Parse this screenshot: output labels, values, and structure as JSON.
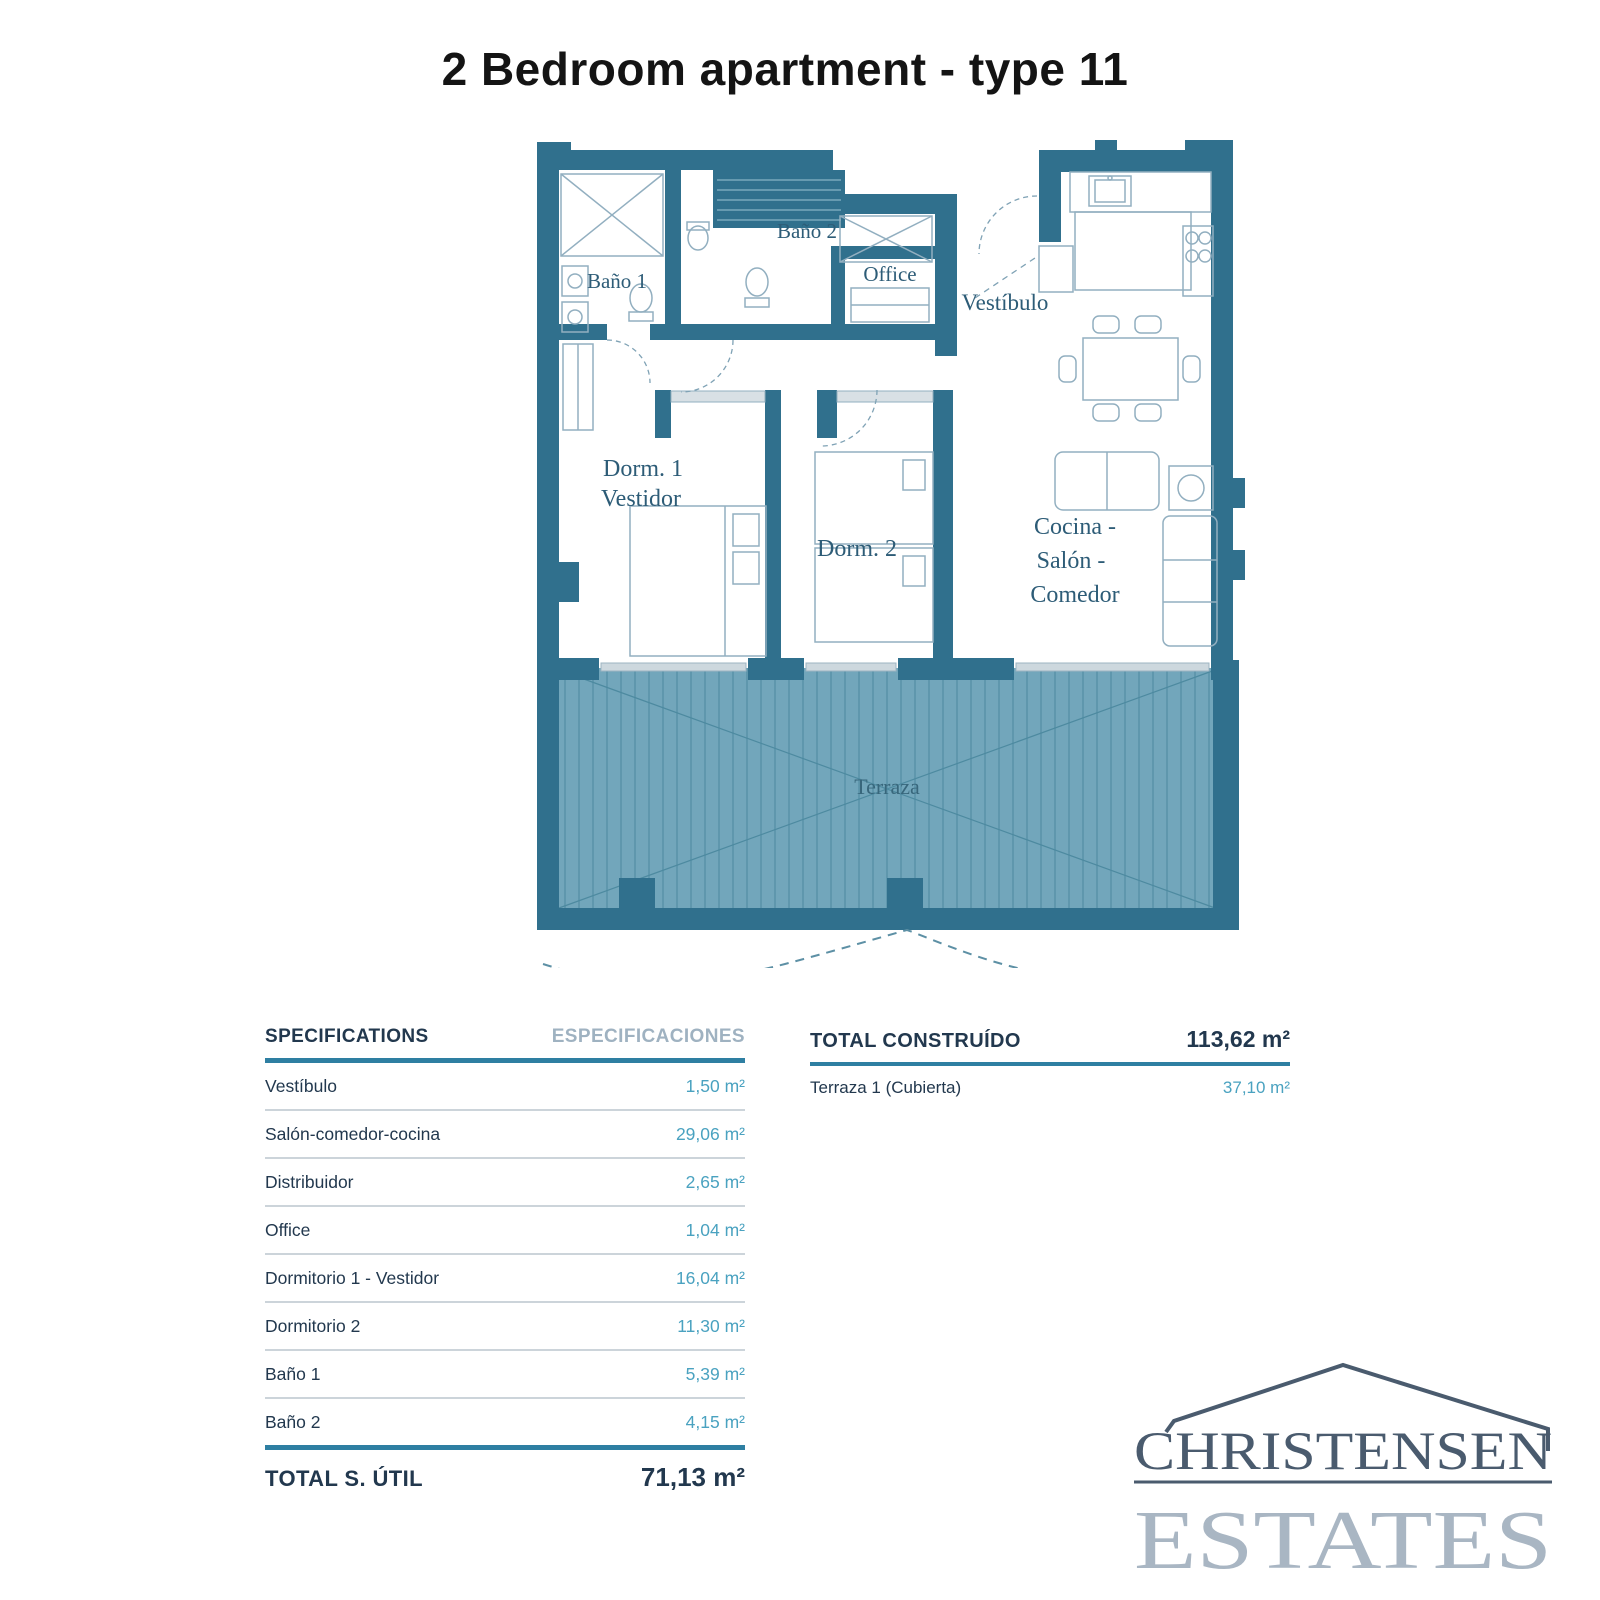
{
  "title": "2 Bedroom apartment - type 11",
  "floorplan": {
    "labels": {
      "bano1": "Baño 1",
      "bano2": "Baño 2",
      "office": "Office",
      "vestibulo": "Vestíbulo",
      "dorm1_line1": "Dorm. 1",
      "dorm1_line2": "Vestidor",
      "dorm2": "Dorm. 2",
      "salon_line1": "Cocina -",
      "salon_line2": "Salón -",
      "salon_line3": "Comedor",
      "terraza": "Terraza"
    },
    "colors": {
      "wall": "#30708d",
      "terrace_fill": "#72a6bb",
      "terrace_stripe": "#5f97ad",
      "furniture_line": "#92afc0",
      "room_label": "#2d5c77"
    }
  },
  "spec_table": {
    "header_en": "SPECIFICATIONS",
    "header_es": "ESPECIFICACIONES",
    "rows": [
      {
        "label": "Vestíbulo",
        "value": "1,50 m²"
      },
      {
        "label": "Salón-comedor-cocina",
        "value": "29,06 m²"
      },
      {
        "label": "Distribuidor",
        "value": "2,65 m²"
      },
      {
        "label": "Office",
        "value": "1,04 m²"
      },
      {
        "label": "Dormitorio 1 - Vestidor",
        "value": "16,04 m²"
      },
      {
        "label": "Dormitorio 2",
        "value": "11,30 m²"
      },
      {
        "label": "Baño 1",
        "value": "5,39 m²"
      },
      {
        "label": "Baño 2",
        "value": "4,15 m²"
      }
    ],
    "total_label": "TOTAL S. ÚTIL",
    "total_value": "71,13 m²"
  },
  "built_table": {
    "header_label": "TOTAL CONSTRUÍDO",
    "header_value": "113,62 m²",
    "rows": [
      {
        "label": "Terraza 1 (Cubierta)",
        "value": "37,10 m²"
      }
    ]
  },
  "logo": {
    "name": "CHRISTENSEN",
    "sub": "ESTATES",
    "color_dark": "#4a5b6e",
    "color_light": "#a9b6c3"
  },
  "table_colors": {
    "accent_rule": "#2e7fa2",
    "value_teal": "#4aa2c0",
    "navy": "#22384e",
    "muted_header": "#9fb2c1"
  }
}
